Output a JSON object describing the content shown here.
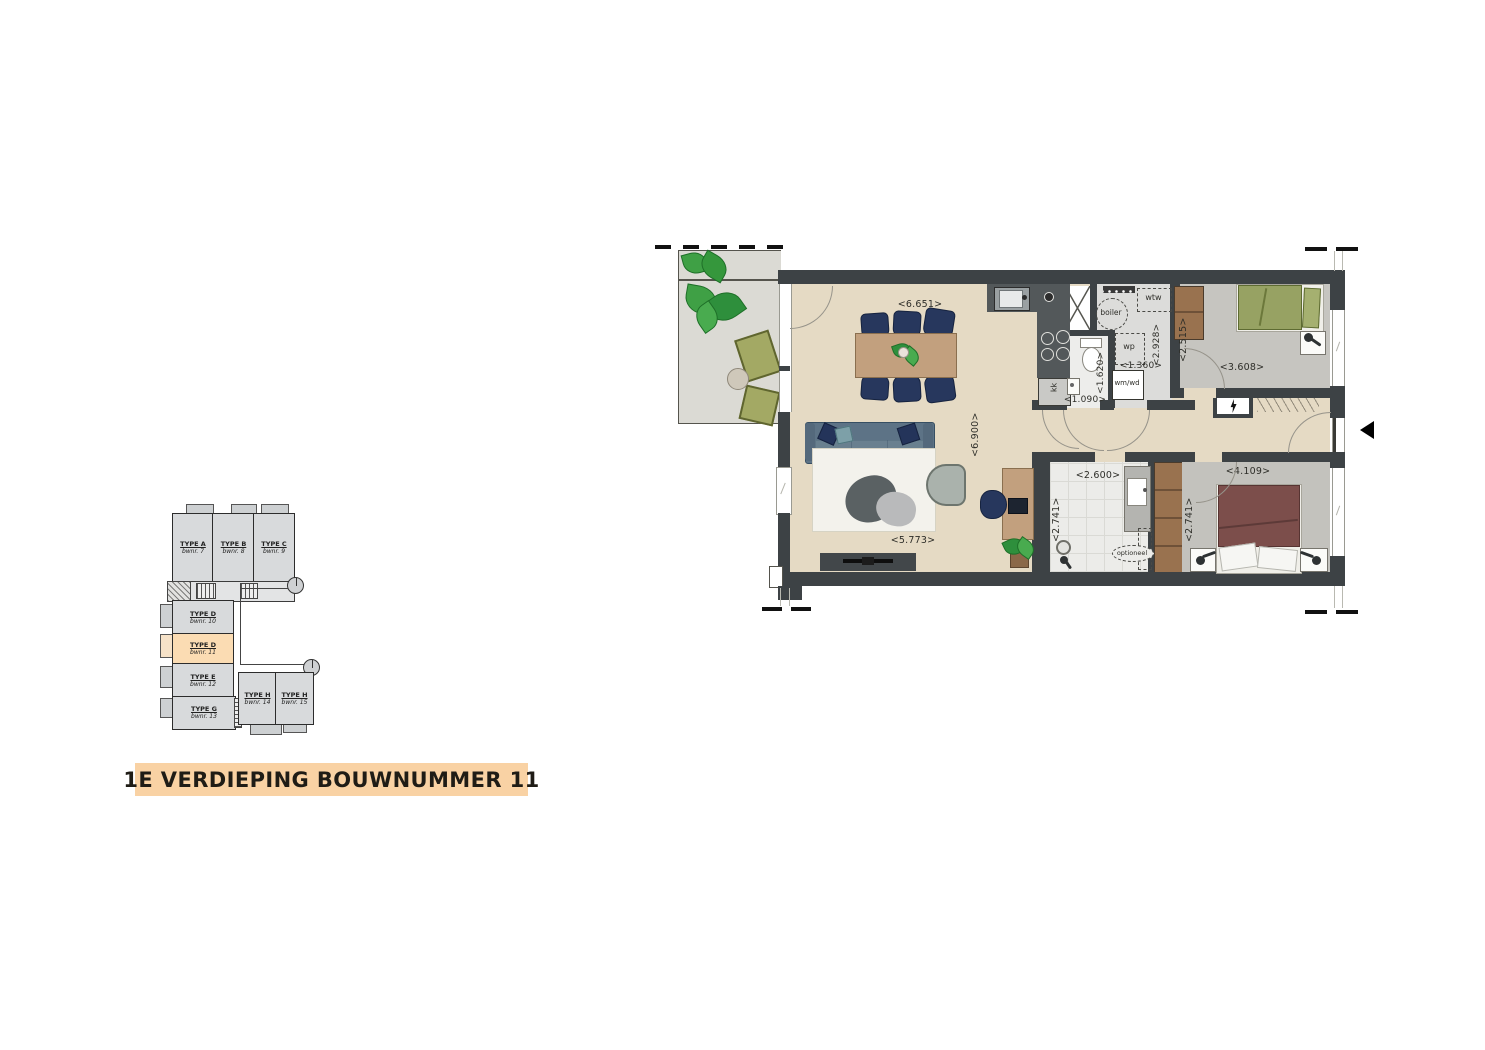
{
  "title": "1E VERDIEPING BOUWNUMMER 11",
  "overview": {
    "units": [
      {
        "type": "TYPE A",
        "bwnr": "bwnr. 7"
      },
      {
        "type": "TYPE B",
        "bwnr": "bwnr. 8"
      },
      {
        "type": "TYPE C",
        "bwnr": "bwnr. 9"
      },
      {
        "type": "TYPE D",
        "bwnr": "bwnr. 10"
      },
      {
        "type": "TYPE D",
        "bwnr": "bwnr. 11",
        "highlight": true
      },
      {
        "type": "TYPE E",
        "bwnr": "bwnr. 12"
      },
      {
        "type": "TYPE G",
        "bwnr": "bwnr. 13"
      },
      {
        "type": "TYPE H",
        "bwnr": "bwnr. 14"
      },
      {
        "type": "TYPE H",
        "bwnr": "bwnr. 15"
      }
    ]
  },
  "plan": {
    "dims": {
      "dining_width": "<6.651>",
      "living_depth": "<6.900>",
      "living_width": "<5.773>",
      "wc_width": "<1.090>",
      "wc_depth": "<1.620>",
      "tech_width": "<1.360>",
      "tech_depth": "<2.928>",
      "bedroom2_depth": "<2.515>",
      "bedroom2_width": "<3.608>",
      "bath_width": "<2.600>",
      "bath_depth": "<2.741>",
      "bedroom1_width": "<4.109>",
      "bedroom1_depth": "<2.741>"
    },
    "labels": {
      "wtw": "wtw",
      "boiler": "boiler",
      "wp": "wp",
      "wmwd": "wm/wd",
      "kk": "kk",
      "optioneel": "optioneel"
    },
    "colors": {
      "wall": "#3d4245",
      "living_floor": "#e5dac4",
      "highlight": "#f9d2a4"
    }
  }
}
